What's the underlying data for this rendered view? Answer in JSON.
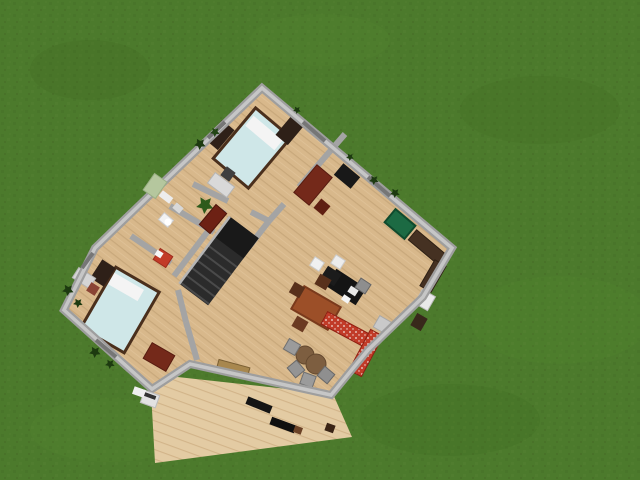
{
  "canvas": {
    "width": 640,
    "height": 480
  },
  "palette": {
    "grass": "#4c7a2c",
    "floor_wood": "#d8b88b",
    "deck_wood": "#e3cba3",
    "wall_gray": "#9e9e9e",
    "wall_core": "#c6c6c6",
    "bed_blue": "#cfe7e8",
    "accent_red_sofa": "#c13b28",
    "dark_red_furniture": "#74291a",
    "kitchen_green": "#1c6a43"
  },
  "elements": [
    {
      "n": "grass-field",
      "t": "bg",
      "i": false,
      "f": "@grasstex"
    },
    {
      "n": "grass-shade",
      "t": "ellipse",
      "i": false,
      "x": 90,
      "y": 70,
      "rx": 60,
      "ry": 30,
      "f": "rgba(62,104,30,0.25)"
    },
    {
      "n": "grass-shade",
      "t": "ellipse",
      "i": false,
      "x": 320,
      "y": 40,
      "rx": 70,
      "ry": 26,
      "f": "rgba(90,140,50,0.18)"
    },
    {
      "n": "grass-shade",
      "t": "ellipse",
      "i": false,
      "x": 540,
      "y": 110,
      "rx": 80,
      "ry": 34,
      "f": "rgba(62,104,30,0.22)"
    },
    {
      "n": "grass-shade",
      "t": "ellipse",
      "i": false,
      "x": 560,
      "y": 320,
      "rx": 90,
      "ry": 44,
      "f": "rgba(90,140,50,0.16)"
    },
    {
      "n": "grass-shade",
      "t": "ellipse",
      "i": false,
      "x": 450,
      "y": 420,
      "rx": 90,
      "ry": 36,
      "f": "rgba(62,104,30,0.20)"
    },
    {
      "n": "grass-shade",
      "t": "ellipse",
      "i": false,
      "x": 110,
      "y": 430,
      "rx": 80,
      "ry": 32,
      "f": "rgba(90,140,50,0.18)"
    },
    {
      "n": "deck-terrace",
      "t": "poly",
      "i": true,
      "f": "@deck",
      "p": [
        [
          150,
          374
        ],
        [
          333,
          394
        ],
        [
          352,
          437
        ],
        [
          155,
          463
        ]
      ]
    },
    {
      "n": "house-floor",
      "t": "poly",
      "i": true,
      "f": "@floor",
      "p": [
        [
          262,
          88
        ],
        [
          452,
          248
        ],
        [
          423,
          297
        ],
        [
          368,
          350
        ],
        [
          331,
          395
        ],
        [
          190,
          364
        ],
        [
          152,
          389
        ],
        [
          64,
          310
        ],
        [
          95,
          248
        ],
        [
          150,
          195
        ]
      ]
    },
    {
      "n": "wall-bedroom1-right",
      "t": "line",
      "i": true,
      "x1": 345,
      "y1": 134,
      "x2": 299,
      "y2": 187,
      "sk": "#a4a4a4",
      "sw": 6
    },
    {
      "n": "wall-bedroom1-right-stub",
      "t": "line",
      "i": true,
      "x1": 284,
      "y1": 204,
      "x2": 269,
      "y2": 221,
      "sk": "#a4a4a4",
      "sw": 6
    },
    {
      "n": "wall-bedroom1-bottom",
      "t": "line",
      "i": true,
      "x1": 193,
      "y1": 184,
      "x2": 228,
      "y2": 201,
      "sk": "#a4a4a4",
      "sw": 6
    },
    {
      "n": "wall-bedroom1-bottom-stub",
      "t": "line",
      "i": true,
      "x1": 251,
      "y1": 212,
      "x2": 269,
      "y2": 221,
      "sk": "#a4a4a4",
      "sw": 6
    },
    {
      "n": "wall-hall-greatroom",
      "t": "line",
      "i": true,
      "x1": 269,
      "y1": 221,
      "x2": 248,
      "y2": 248,
      "sk": "#a4a4a4",
      "sw": 6
    },
    {
      "n": "wall-bathroom-top",
      "t": "line",
      "i": true,
      "x1": 170,
      "y1": 206,
      "x2": 214,
      "y2": 232,
      "sk": "#a4a4a4",
      "sw": 6
    },
    {
      "n": "wall-stairwell",
      "t": "line",
      "i": true,
      "x1": 224,
      "y1": 210,
      "x2": 174,
      "y2": 276,
      "sk": "#a4a4a4",
      "sw": 6
    },
    {
      "n": "wall-bedroom2-top",
      "t": "line",
      "i": true,
      "x1": 131,
      "y1": 236,
      "x2": 171,
      "y2": 263,
      "sk": "#a4a4a4",
      "sw": 6
    },
    {
      "n": "wall-bedroom2-right",
      "t": "line",
      "i": true,
      "x1": 178,
      "y1": 290,
      "x2": 186,
      "y2": 322,
      "sk": "#a4a4a4",
      "sw": 6
    },
    {
      "n": "wall-bedroom2-right-low",
      "t": "line",
      "i": true,
      "x1": 186,
      "y1": 322,
      "x2": 197,
      "y2": 360,
      "sk": "#a4a4a4",
      "sw": 6
    },
    {
      "n": "bed-double-top",
      "t": "rect",
      "i": true,
      "x": 252,
      "y": 148,
      "w": 46,
      "h": 66,
      "a": 40,
      "f": "#cfe7e8",
      "sk": "#4a2f1c",
      "sw": 3
    },
    {
      "n": "bed-pillow",
      "t": "rect",
      "i": false,
      "x": 264,
      "y": 133,
      "w": 38,
      "h": 13,
      "a": 40,
      "f": "#f4f4f4"
    },
    {
      "n": "bookshelf",
      "t": "rect",
      "i": true,
      "x": 220,
      "y": 135,
      "w": 16,
      "h": 26,
      "a": 40,
      "f": "#2e2018"
    },
    {
      "n": "bookshelf",
      "t": "rect",
      "i": true,
      "x": 290,
      "y": 130,
      "w": 16,
      "h": 26,
      "a": 40,
      "f": "#2e2018"
    },
    {
      "n": "desk-bedroom1",
      "t": "rect",
      "i": true,
      "x": 221,
      "y": 185,
      "w": 24,
      "h": 13,
      "a": 37,
      "f": "#d9d9d9",
      "sk": "#b5b5b5",
      "sw": 1
    },
    {
      "n": "chair-bedroom1",
      "t": "rect",
      "i": true,
      "x": 228,
      "y": 174,
      "w": 11,
      "h": 11,
      "a": 37,
      "f": "#3f3f3f"
    },
    {
      "n": "red-desk-bedroom1",
      "t": "rect",
      "i": true,
      "x": 313,
      "y": 185,
      "w": 20,
      "h": 36,
      "a": 40,
      "f": "#74291a",
      "sk": "#571c10",
      "sw": 1
    },
    {
      "n": "red-chair-bedroom1",
      "t": "rect",
      "i": true,
      "x": 322,
      "y": 207,
      "w": 12,
      "h": 12,
      "a": 40,
      "f": "#5f1f12"
    },
    {
      "n": "plant-pot",
      "t": "bush",
      "i": true,
      "x": 205,
      "y": 205,
      "r": 9,
      "f": "#2d5a1b"
    },
    {
      "n": "wardrobe-hall",
      "t": "rect",
      "i": true,
      "x": 213,
      "y": 219,
      "w": 14,
      "h": 26,
      "a": 40,
      "f": "#6d2114",
      "sk": "#4e160c",
      "sw": 1
    },
    {
      "n": "door-leaf-entrance",
      "t": "rect",
      "i": true,
      "x": 166,
      "y": 197,
      "w": 13,
      "h": 7,
      "a": 37,
      "f": "#ededed"
    },
    {
      "n": "door-leaf-hall",
      "t": "rect",
      "i": true,
      "x": 232,
      "y": 226,
      "w": 13,
      "h": 7,
      "a": 35,
      "f": "#ededed"
    },
    {
      "n": "toilet",
      "t": "rect",
      "i": true,
      "x": 166,
      "y": 220,
      "w": 12,
      "h": 9,
      "a": 40,
      "f": "#f2f2f2",
      "sk": "#cccccc",
      "sw": 1
    },
    {
      "n": "toilet-bowl",
      "t": "circle",
      "i": false,
      "x": 168,
      "y": 222,
      "r": 3.5,
      "f": "#ffffff"
    },
    {
      "n": "bathroom-sink",
      "t": "rect",
      "i": true,
      "x": 178,
      "y": 208,
      "w": 9,
      "h": 7,
      "a": 40,
      "f": "#d8d8d8"
    },
    {
      "n": "staircase",
      "t": "stairs",
      "i": true,
      "x": 219,
      "y": 261,
      "w": 36,
      "h": 84,
      "a": 37,
      "f": "#2b2b2b",
      "landing": "#191919",
      "step": "#4a4a4a",
      "rail": "#b5b5b5"
    },
    {
      "n": "bed-double-left",
      "t": "rect",
      "i": true,
      "x": 120,
      "y": 310,
      "w": 50,
      "h": 70,
      "a": 30,
      "f": "#cfe7e8",
      "sk": "#4a2f1c",
      "sw": 3
    },
    {
      "n": "bed-pillow",
      "t": "rect",
      "i": false,
      "x": 126,
      "y": 287,
      "w": 34,
      "h": 13,
      "a": 30,
      "f": "#f4f4f4"
    },
    {
      "n": "bookshelf",
      "t": "rect",
      "i": true,
      "x": 103,
      "y": 273,
      "w": 16,
      "h": 22,
      "a": 33,
      "f": "#2e2018"
    },
    {
      "n": "desk-bedroom2",
      "t": "rect",
      "i": true,
      "x": 84,
      "y": 278,
      "w": 20,
      "h": 12,
      "a": 33,
      "f": "#d5d5d5",
      "sk": "#b5b5b5",
      "sw": 1
    },
    {
      "n": "chair-bedroom2",
      "t": "rect",
      "i": true,
      "x": 93,
      "y": 289,
      "w": 10,
      "h": 10,
      "a": 33,
      "f": "#8a4434"
    },
    {
      "n": "striped-chair",
      "t": "rect",
      "i": true,
      "x": 163,
      "y": 258,
      "w": 15,
      "h": 13,
      "a": 33,
      "f": "#c23b28",
      "sk": "#9c2c1c",
      "sw": 1
    },
    {
      "n": "striped-chair-cushion",
      "t": "rect",
      "i": false,
      "x": 159,
      "y": 254,
      "w": 7,
      "h": 6,
      "a": 33,
      "f": "#f5f5f5"
    },
    {
      "n": "red-desk-bedroom2",
      "t": "rect",
      "i": true,
      "x": 159,
      "y": 357,
      "w": 26,
      "h": 18,
      "a": 30,
      "f": "#74291a",
      "sk": "#571c10",
      "sw": 1
    },
    {
      "n": "tv-cabinet",
      "t": "rect",
      "i": true,
      "x": 347,
      "y": 176,
      "w": 22,
      "h": 15,
      "a": 40,
      "f": "#181818"
    },
    {
      "n": "refrigerator",
      "t": "rect",
      "i": true,
      "x": 400,
      "y": 224,
      "w": 26,
      "h": 17,
      "a": 40,
      "f": "#1c6a43",
      "sk": "#0f4a2d",
      "sw": 2
    },
    {
      "n": "kitchen-counter",
      "t": "rect",
      "i": true,
      "x": 427,
      "y": 247,
      "w": 38,
      "h": 13,
      "a": 40,
      "f": "#453122",
      "sk": "#2e2014",
      "sw": 1
    },
    {
      "n": "kitchen-counter",
      "t": "rect",
      "i": true,
      "x": 433,
      "y": 276,
      "w": 13,
      "h": 30,
      "a": 30,
      "f": "#453122",
      "sk": "#2e2014",
      "sw": 1
    },
    {
      "n": "stove",
      "t": "rect",
      "i": true,
      "x": 425,
      "y": 300,
      "w": 15,
      "h": 16,
      "a": 30,
      "f": "#e9e9e9",
      "sk": "#bbbbbb",
      "sw": 1
    },
    {
      "n": "kitchen-counter",
      "t": "rect",
      "i": true,
      "x": 419,
      "y": 322,
      "w": 12,
      "h": 14,
      "a": 30,
      "f": "#38281b"
    },
    {
      "n": "kitchen-island",
      "t": "rect",
      "i": true,
      "x": 346,
      "y": 287,
      "w": 36,
      "h": 20,
      "a": 33,
      "f": "#141414"
    },
    {
      "n": "kitchen-island-wing",
      "t": "rect",
      "i": true,
      "x": 331,
      "y": 276,
      "w": 16,
      "h": 14,
      "a": 33,
      "f": "#1b1b1b"
    },
    {
      "n": "island-sink",
      "t": "rect",
      "i": false,
      "x": 353,
      "y": 291,
      "w": 9,
      "h": 7,
      "a": 33,
      "f": "#e8e8e8"
    },
    {
      "n": "island-stool",
      "t": "rect",
      "i": true,
      "x": 317,
      "y": 264,
      "w": 11,
      "h": 10,
      "a": 33,
      "f": "#f0f0f0",
      "sk": "#cccccc",
      "sw": 1
    },
    {
      "n": "island-stool",
      "t": "rect",
      "i": true,
      "x": 338,
      "y": 262,
      "w": 11,
      "h": 10,
      "a": 33,
      "f": "#ececec",
      "sk": "#cccccc",
      "sw": 1
    },
    {
      "n": "island-chair",
      "t": "rect",
      "i": true,
      "x": 363,
      "y": 286,
      "w": 12,
      "h": 11,
      "a": 33,
      "f": "#8e8e8e",
      "sk": "#676767",
      "sw": 1
    },
    {
      "n": "island-paper",
      "t": "rect",
      "i": false,
      "x": 346,
      "y": 299,
      "w": 8,
      "h": 6,
      "a": 33,
      "f": "#f5f5f5"
    },
    {
      "n": "dining-table",
      "t": "rect",
      "i": true,
      "x": 316,
      "y": 308,
      "w": 42,
      "h": 26,
      "a": 30,
      "f": "#9c4f28",
      "sk": "#7a3a1c",
      "sw": 2
    },
    {
      "n": "dining-chair",
      "t": "rect",
      "i": true,
      "x": 323,
      "y": 282,
      "w": 13,
      "h": 12,
      "a": 30,
      "f": "#58301b"
    },
    {
      "n": "dining-chair",
      "t": "rect",
      "i": true,
      "x": 297,
      "y": 290,
      "w": 12,
      "h": 12,
      "a": 30,
      "f": "#58301b"
    },
    {
      "n": "dining-chair",
      "t": "rect",
      "i": true,
      "x": 300,
      "y": 324,
      "w": 13,
      "h": 12,
      "a": 30,
      "f": "#6b3a22"
    },
    {
      "n": "sofa-red",
      "t": "rect",
      "i": true,
      "x": 349,
      "y": 331,
      "w": 56,
      "h": 14,
      "a": 28,
      "f": "@sofa",
      "sk": "#8e1f12",
      "sw": 1
    },
    {
      "n": "sofa-red",
      "t": "rect",
      "i": true,
      "x": 366,
      "y": 353,
      "w": 14,
      "h": 46,
      "a": 28,
      "f": "@sofa",
      "sk": "#8e1f12",
      "sw": 1
    },
    {
      "n": "side-table",
      "t": "rect",
      "i": true,
      "x": 383,
      "y": 325,
      "w": 15,
      "h": 13,
      "a": 30,
      "f": "#c9c9c9",
      "sk": "#a8a8a8",
      "sw": 1
    },
    {
      "n": "coffee-table",
      "t": "circle",
      "i": true,
      "x": 305,
      "y": 355,
      "r": 9,
      "f": "#7d5e40",
      "sk": "#64492f",
      "sw": 1
    },
    {
      "n": "coffee-table",
      "t": "circle",
      "i": true,
      "x": 316,
      "y": 364,
      "r": 10,
      "f": "#7d5e40",
      "sk": "#64492f",
      "sw": 1
    },
    {
      "n": "lounge-chair",
      "t": "rect",
      "i": true,
      "x": 292,
      "y": 347,
      "w": 13,
      "h": 12,
      "a": 30,
      "f": "#9b9b9b",
      "sk": "#707070",
      "sw": 1
    },
    {
      "n": "lounge-chair",
      "t": "rect",
      "i": true,
      "x": 296,
      "y": 369,
      "w": 13,
      "h": 12,
      "a": 50,
      "f": "#949494",
      "sk": "#6a6a6a",
      "sw": 1
    },
    {
      "n": "lounge-chair",
      "t": "rect",
      "i": true,
      "x": 308,
      "y": 380,
      "w": 13,
      "h": 12,
      "a": 20,
      "f": "#9b9b9b",
      "sk": "#707070",
      "sw": 1
    },
    {
      "n": "lounge-chair",
      "t": "rect",
      "i": true,
      "x": 326,
      "y": 375,
      "w": 13,
      "h": 12,
      "a": 40,
      "f": "#8f8f8f",
      "sk": "#686868",
      "sw": 1
    },
    {
      "n": "sideboard",
      "t": "rect",
      "i": true,
      "x": 233,
      "y": 369,
      "w": 32,
      "h": 11,
      "a": 15,
      "f": "#a8874e",
      "sk": "#7a5f33",
      "sw": 1
    },
    {
      "n": "house-outer-wall",
      "t": "outline",
      "i": true,
      "sk": "#9e9e9e",
      "sw": 8,
      "core": "#c6c6c6",
      "cw": 3.5,
      "p": [
        [
          262,
          88
        ],
        [
          452,
          248
        ],
        [
          423,
          297
        ],
        [
          368,
          350
        ],
        [
          331,
          395
        ],
        [
          190,
          364
        ],
        [
          152,
          389
        ],
        [
          64,
          310
        ],
        [
          95,
          248
        ],
        [
          150,
          195
        ]
      ]
    },
    {
      "n": "window",
      "t": "line",
      "i": true,
      "x1": 208,
      "y1": 138,
      "x2": 225,
      "y2": 122,
      "sk": "#767676",
      "sw": 4
    },
    {
      "n": "window",
      "t": "line",
      "i": true,
      "x1": 82,
      "y1": 268,
      "x2": 93,
      "y2": 253,
      "sk": "#767676",
      "sw": 4
    },
    {
      "n": "window",
      "t": "line",
      "i": true,
      "x1": 96,
      "y1": 340,
      "x2": 116,
      "y2": 357,
      "sk": "#767676",
      "sw": 4
    },
    {
      "n": "window",
      "t": "line",
      "i": true,
      "x1": 303,
      "y1": 122,
      "x2": 325,
      "y2": 141,
      "sk": "#767676",
      "sw": 4
    },
    {
      "n": "window",
      "t": "line",
      "i": true,
      "x1": 368,
      "y1": 177,
      "x2": 390,
      "y2": 196,
      "sk": "#767676",
      "sw": 4
    },
    {
      "n": "entrance-doormat",
      "t": "rect",
      "i": false,
      "x": 155,
      "y": 186,
      "w": 15,
      "h": 20,
      "a": 35,
      "f": "#b5c79e",
      "sk": "#9aaf85",
      "sw": 1
    },
    {
      "n": "grill",
      "t": "rect",
      "i": true,
      "x": 150,
      "y": 399,
      "w": 16,
      "h": 13,
      "a": 20,
      "f": "#e2e2e2",
      "sk": "#bdbdbd",
      "sw": 1
    },
    {
      "n": "grill-top",
      "t": "rect",
      "i": false,
      "x": 150,
      "y": 396,
      "w": 12,
      "h": 4,
      "a": 20,
      "f": "#333333"
    },
    {
      "n": "deck-doormat",
      "t": "rect",
      "i": false,
      "x": 139,
      "y": 392,
      "w": 12,
      "h": 8,
      "a": 20,
      "f": "#f0f0f0"
    },
    {
      "n": "deck-bench",
      "t": "rect",
      "i": true,
      "x": 259,
      "y": 405,
      "w": 26,
      "h": 8,
      "a": 22,
      "f": "#141414"
    },
    {
      "n": "deck-bench",
      "t": "rect",
      "i": true,
      "x": 283,
      "y": 425,
      "w": 26,
      "h": 8,
      "a": 20,
      "f": "#0f0f0f"
    },
    {
      "n": "deck-stool",
      "t": "rect",
      "i": true,
      "x": 298,
      "y": 430,
      "w": 8,
      "h": 7,
      "a": 20,
      "f": "#6b4226"
    },
    {
      "n": "deck-stool",
      "t": "rect",
      "i": true,
      "x": 330,
      "y": 428,
      "w": 9,
      "h": 8,
      "a": 20,
      "f": "#3a2415"
    },
    {
      "n": "shrub",
      "t": "bush",
      "i": true,
      "x": 200,
      "y": 144,
      "r": 6,
      "f": "#1d3a10"
    },
    {
      "n": "shrub",
      "t": "bush",
      "i": true,
      "x": 215,
      "y": 132,
      "r": 5,
      "f": "#22451402"
    },
    {
      "n": "shrub",
      "t": "bush",
      "i": true,
      "x": 297,
      "y": 110,
      "r": 4,
      "f": "#1d3a10"
    },
    {
      "n": "shrub",
      "t": "bush",
      "i": true,
      "x": 350,
      "y": 157,
      "r": 4,
      "f": "#1d3a10"
    },
    {
      "n": "shrub",
      "t": "bush",
      "i": true,
      "x": 374,
      "y": 180,
      "r": 5,
      "f": "#1d3a10"
    },
    {
      "n": "shrub",
      "t": "bush",
      "i": true,
      "x": 395,
      "y": 193,
      "r": 5,
      "f": "#1d3a10"
    },
    {
      "n": "shrub",
      "t": "bush",
      "i": true,
      "x": 68,
      "y": 290,
      "r": 6,
      "f": "#1d3a10"
    },
    {
      "n": "shrub",
      "t": "bush",
      "i": true,
      "x": 78,
      "y": 303,
      "r": 5,
      "f": "#1d3a10"
    },
    {
      "n": "shrub",
      "t": "bush",
      "i": true,
      "x": 95,
      "y": 352,
      "r": 6,
      "f": "#1d3a10"
    },
    {
      "n": "shrub",
      "t": "bush",
      "i": true,
      "x": 110,
      "y": 364,
      "r": 5,
      "f": "#1d3a10"
    }
  ]
}
